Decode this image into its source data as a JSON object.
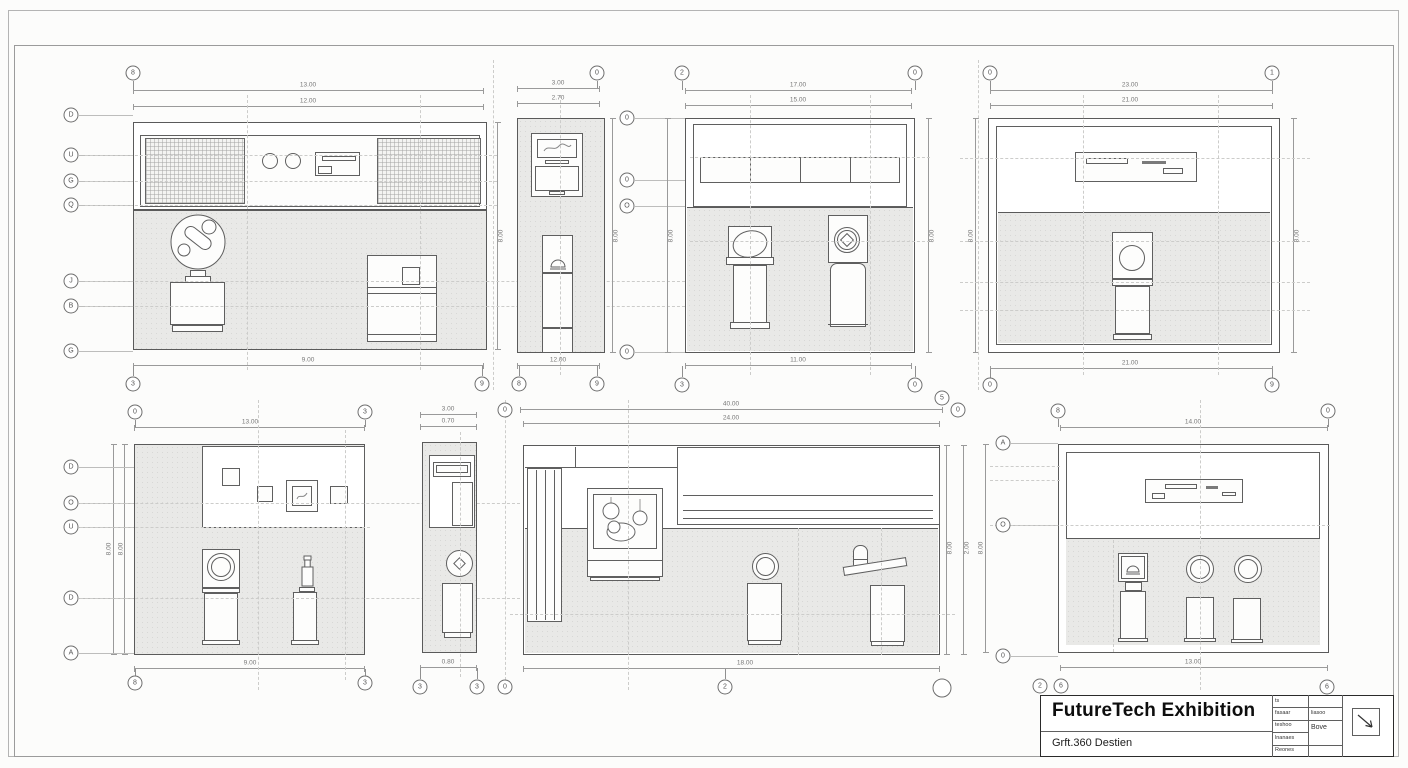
{
  "title_block": {
    "title": "FutureTech Exhibition",
    "subtitle": "Grft.360 Destien",
    "table": {
      "c1r1": "ts",
      "c1r2": "fasaar",
      "c1r3": "teshoo",
      "c1r4": "lnanaes",
      "c1r5": "Reones",
      "c2r2": "liasoo",
      "c2r3": "Bove"
    }
  },
  "d1": {
    "bubble_top": "8",
    "bubbles_bottom": [
      "3",
      "9"
    ],
    "bubbles_left": [
      "D",
      "U",
      "G",
      "Q",
      "J",
      "B",
      "G"
    ],
    "dims": {
      "top1": "13.00",
      "top2": "12.00",
      "bottom": "9.00",
      "right": "8.00"
    }
  },
  "d2": {
    "bubble_top": "0",
    "bubbles_bottom": [
      "8",
      "9"
    ],
    "bubbles_right": [
      "0",
      "0",
      "O",
      "0"
    ],
    "dims": {
      "top1": "3.00",
      "top2": "2.70",
      "bottom": "12.00",
      "right": "8.00"
    }
  },
  "d3": {
    "bubbles_top": [
      "2",
      "0"
    ],
    "bubbles_bottom": [
      "3",
      "0"
    ],
    "dims": {
      "top1": "17.00",
      "top2": "15.00",
      "bottom": "11.00",
      "left": "8.00",
      "right": "8.00"
    }
  },
  "d4": {
    "bubbles_top": [
      "0",
      "1"
    ],
    "bubbles_bottom": [
      "0",
      "9"
    ],
    "dims": {
      "top1": "23.00",
      "top2": "21.00",
      "bottom": "21.00",
      "left": "8.00",
      "right": "8.00"
    }
  },
  "d5": {
    "bubbles_top": [
      "0",
      "3"
    ],
    "bubbles_bottom": [
      "8",
      "3"
    ],
    "bubbles_left": [
      "D",
      "O",
      "U",
      "D",
      "A"
    ],
    "dims": {
      "top": "13.00",
      "bottom": "9.00",
      "left1": "8.00",
      "left2": "8.00"
    }
  },
  "d6": {
    "bubble_top": "0",
    "bubbles_bottom": [
      "3",
      "3",
      "0"
    ],
    "dims": {
      "top1": "3.00",
      "top2": "0.70",
      "bottom": "0.80"
    }
  },
  "d7": {
    "bubbles_top": [
      "5",
      "0"
    ],
    "bubbles_bottom": [
      "2"
    ],
    "dims": {
      "top1": "40.00",
      "top2": "24.00",
      "bottom": "18.00",
      "right1": "8.00",
      "right2": "2.00"
    }
  },
  "d8": {
    "bubbles_top": [
      "8",
      "0"
    ],
    "bubbles_bottom": [
      "2",
      "6",
      "6"
    ],
    "bubbles_left": [
      "A",
      "O",
      "0"
    ],
    "dims": {
      "top": "14.00",
      "bottom": "13.00",
      "left": "8.00"
    }
  }
}
